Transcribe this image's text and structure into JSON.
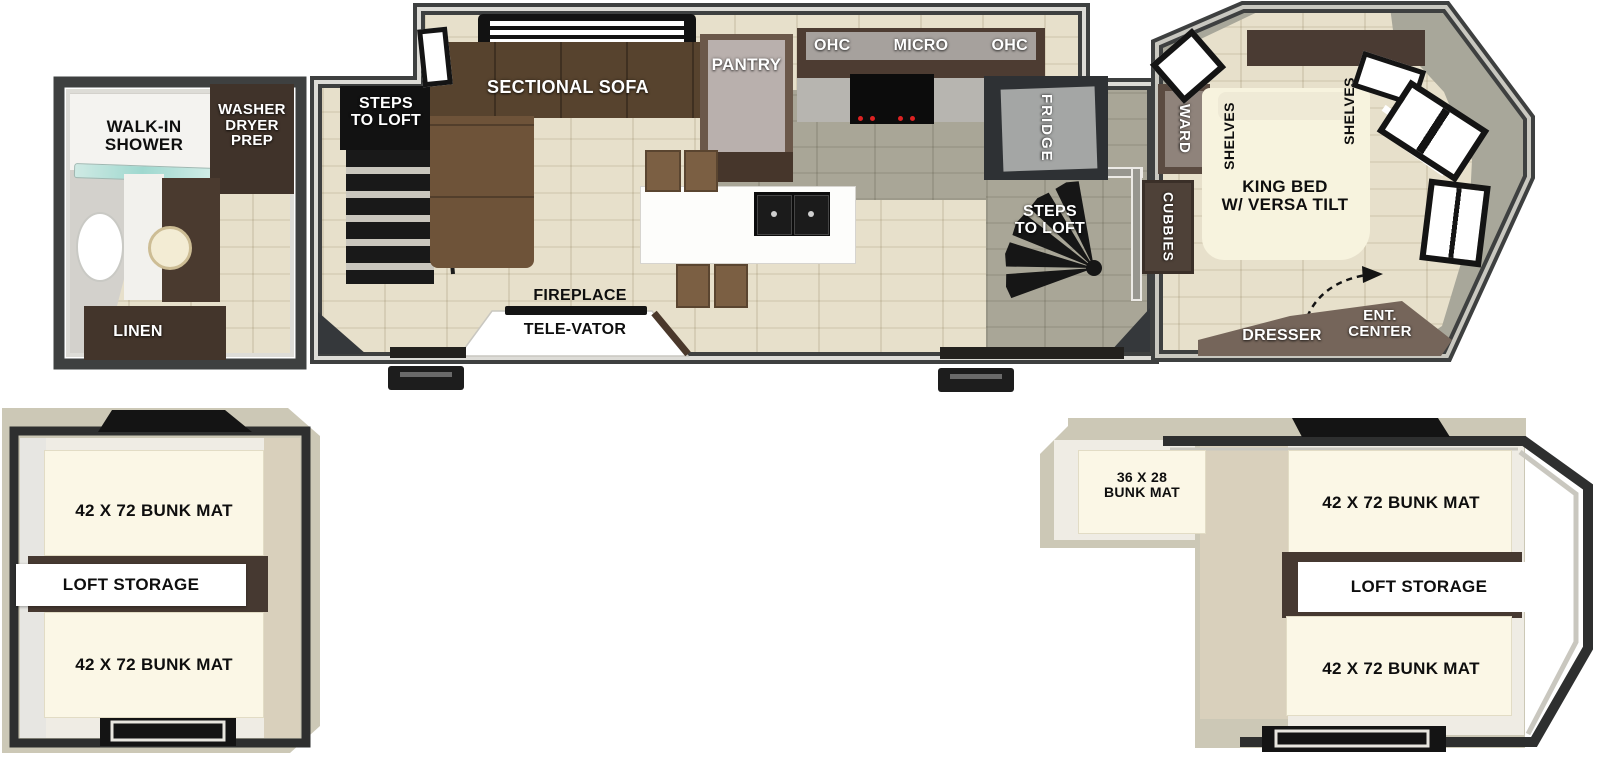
{
  "colors": {
    "wall_dark": "#3e4040",
    "wall_light": "#dddcd7",
    "floor_beige": "#e7e0cb",
    "floor_gray": "#a9a697",
    "sofa_brown": "#5d4730",
    "cabinet_brown": "#43352b",
    "counter_gray": "#b7b5b0",
    "mat_cream": "#fbf7e6",
    "loft_tan": "#ccc8b6",
    "shower_glass": "#a8dcd2",
    "skylight_black": "#141414",
    "dresser_brown": "#75655a"
  },
  "floorplan": {
    "bathroom": {
      "shower_label": "WALK-IN\nSHOWER",
      "washer_label": "WASHER\nDRYER\nPREP",
      "linen_label": "LINEN"
    },
    "living": {
      "steps_left_label": "STEPS\nTO LOFT",
      "sofa_label": "SECTIONAL SOFA",
      "pantry_label": "PANTRY",
      "ohc_left": "OHC",
      "micro": "MICRO",
      "ohc_right": "OHC",
      "fridge_label": "FRIDGE",
      "fireplace_label": "FIREPLACE",
      "televator_label": "TELE-VATOR",
      "steps_right_label": "STEPS\nTO LOFT",
      "cubbies_label": "CUBBIES",
      "ward_label": "WARD"
    },
    "bedroom": {
      "shelves_left_label": "SHELVES",
      "shelves_right_label": "SHELVES",
      "king_bed_label": "KING BED\nW/ VERSA TILT",
      "dresser_label": "DRESSER",
      "ent_center_label": "ENT.\nCENTER"
    },
    "loft_left": {
      "bunk_top": "42 X 72 BUNK MAT",
      "storage": "LOFT STORAGE",
      "bunk_bottom": "42 X 72 BUNK MAT"
    },
    "loft_right": {
      "bunk_small": "36 X 28\nBUNK MAT",
      "bunk_top": "42 X 72 BUNK MAT",
      "storage": "LOFT STORAGE",
      "bunk_bottom": "42 X 72 BUNK MAT"
    }
  }
}
